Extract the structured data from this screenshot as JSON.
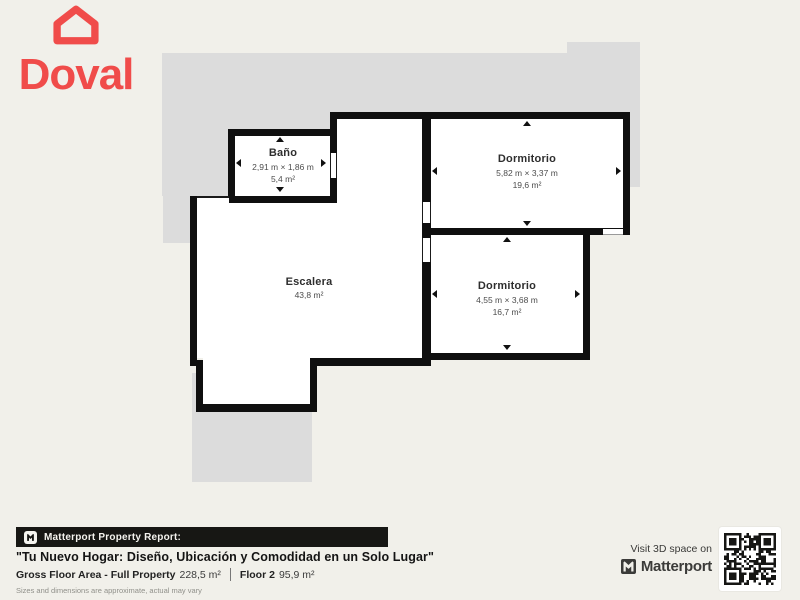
{
  "brand": {
    "name": "Doval",
    "color": "#F04C4A"
  },
  "rooms": [
    {
      "id": "bano",
      "name": "Baño",
      "dimensions": "2,91 m × 1,86 m",
      "area": "5,4 m²"
    },
    {
      "id": "dormitorio1",
      "name": "Dormitorio",
      "dimensions": "5,82 m × 3,37 m",
      "area": "19,6 m²"
    },
    {
      "id": "dormitorio2",
      "name": "Dormitorio",
      "dimensions": "4,55 m × 3,68 m",
      "area": "16,7 m²"
    },
    {
      "id": "escalera",
      "name": "Escalera",
      "area": "43,8 m²"
    }
  ],
  "footer": {
    "report_label": "Matterport Property Report:",
    "title": "\"Tu Nuevo Hogar: Diseño, Ubicación y Comodidad en un Solo Lugar\"",
    "gross_label": "Gross Floor Area - Full Property",
    "gross_value": "228,5 m²",
    "floor_label": "Floor 2",
    "floor_value": "95,9 m²",
    "disclaimer": "Sizes and dimensions are approximate, actual may vary"
  },
  "cta": {
    "visit_text": "Visit 3D space on",
    "brand": "Matterport"
  }
}
